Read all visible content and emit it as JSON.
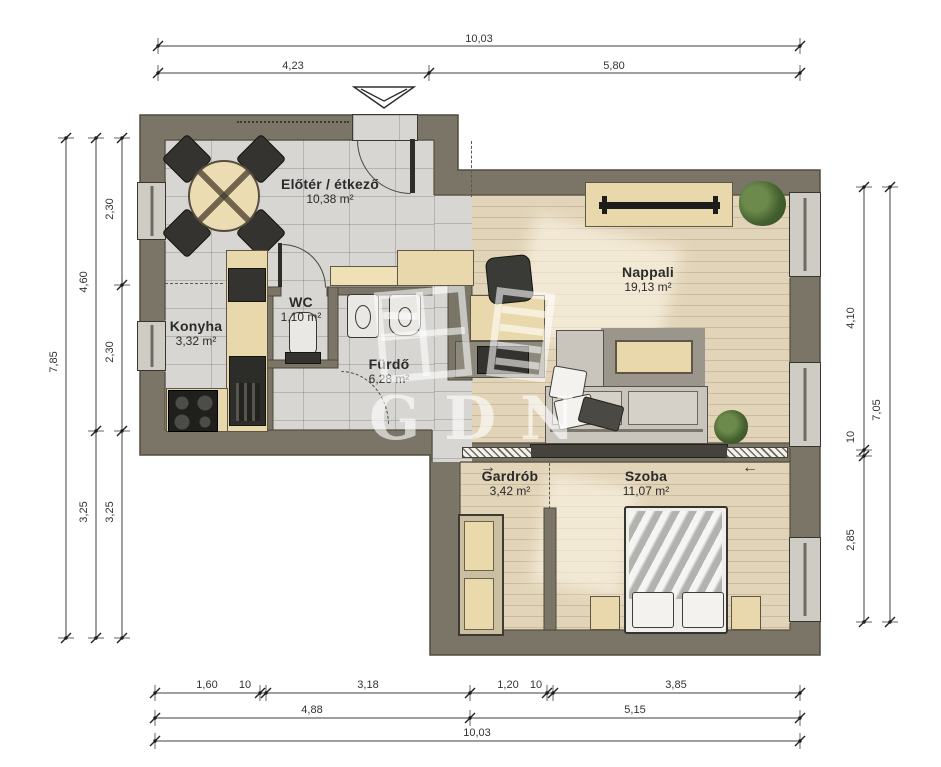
{
  "watermark": {
    "text": "GDN"
  },
  "icons": {
    "slide_right_arrow": "→",
    "slide_left_arrow": "←"
  },
  "colors": {
    "wall": "#7b7568",
    "tile_floor": "#d7d6d3",
    "wood_floor": "#e2d4b8",
    "furniture_wood": "#e9d8ac",
    "label_text": "#2b2b2b"
  },
  "rooms": [
    {
      "name": "Előtér / étkező",
      "area": "10,38 m²"
    },
    {
      "name": "Nappali",
      "area": "19,13 m²"
    },
    {
      "name": "Konyha",
      "area": "3,32 m²"
    },
    {
      "name": "WC",
      "area": "1,10 m²"
    },
    {
      "name": "Fürdő",
      "area": "6,28 m²"
    },
    {
      "name": "Gardrób",
      "area": "3,42 m²"
    },
    {
      "name": "Szoba",
      "area": "11,07 m²"
    }
  ],
  "dimensions": {
    "top": {
      "total": "10,03",
      "seg_a": "4,23",
      "seg_b": "5,80"
    },
    "left": {
      "total": "7,85",
      "mid_a": "4,60",
      "mid_b": "3,25",
      "inner_a": "2,30",
      "inner_b": "2,30",
      "inner_c": "3,25"
    },
    "right": {
      "total": "7,05",
      "inner_a": "4,10",
      "inner_b": "10",
      "inner_c": "2,85"
    },
    "bottom": {
      "row1": [
        "1,60",
        "10",
        "3,18",
        "1,20",
        "10",
        "3,85"
      ],
      "row2_a": "4,88",
      "row2_b": "5,15",
      "total": "10,03"
    }
  }
}
